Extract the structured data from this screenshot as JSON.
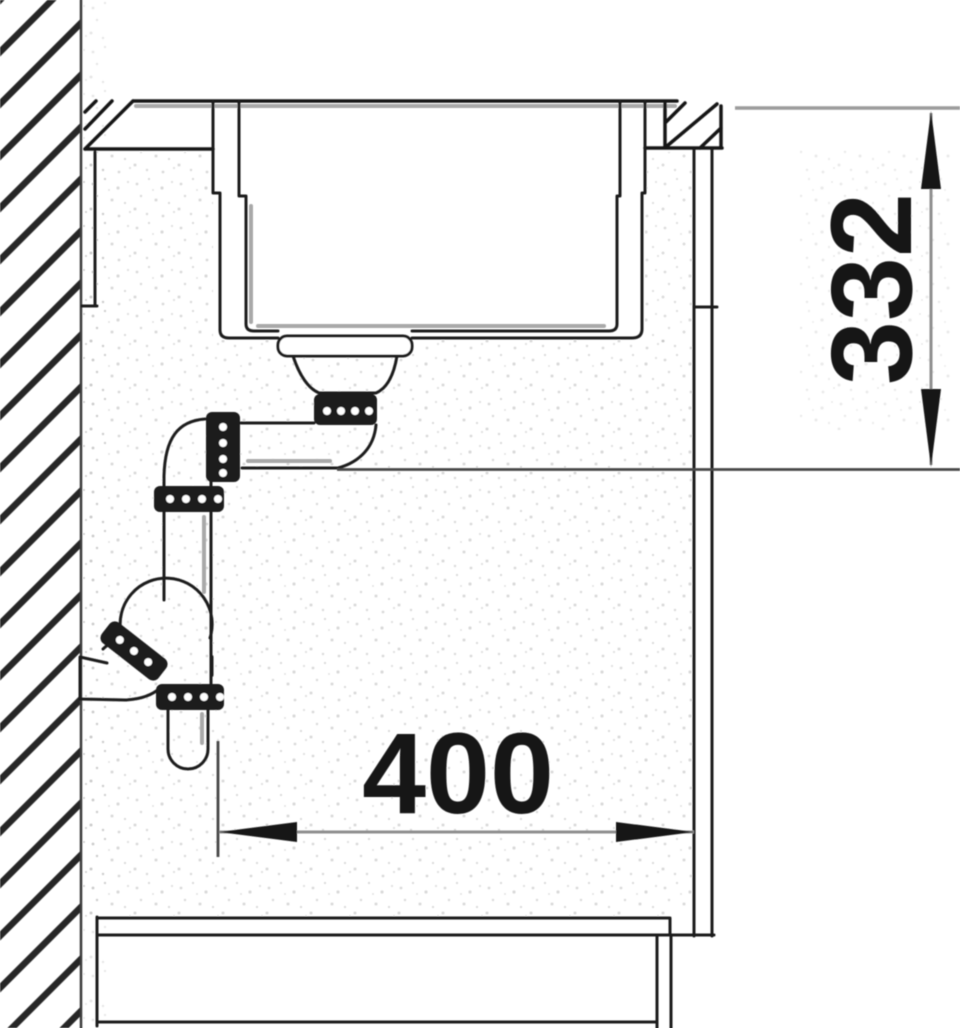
{
  "diagram": {
    "title": "sink-installation-section-drawing",
    "type": "technical line drawing",
    "view": "side cross-section of flush-mounted sink in base cabinet",
    "dimension_labels": {
      "height": "332",
      "width": "400"
    },
    "colors": {
      "background": "#ffffff",
      "line": "#1c1c1c",
      "dim_line": "#8f8f8f",
      "text": "#121212",
      "nut_fill": "#1d1d1d"
    },
    "parts": [
      "wall with section hatching",
      "countertop with cut-out",
      "flush-mounted sink bowl",
      "basket strainer and drain nut",
      "horizontal drain pipe",
      "coupling nuts",
      "space-saving siphon",
      "wall drain connection",
      "base cabinet front",
      "cabinet bottom and plinth"
    ]
  }
}
